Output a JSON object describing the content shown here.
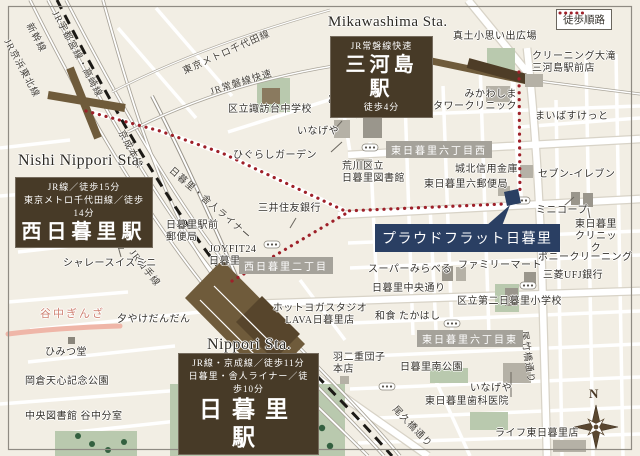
{
  "legend": {
    "label": "徒歩順路"
  },
  "compass": {
    "label": "N"
  },
  "property": {
    "label": "プラウドフラット日暮里"
  },
  "stations": {
    "mikawashima": {
      "en": "Mikawashima Sta.",
      "line1": "JR常磐線快速",
      "name": "三河島駅",
      "walk": "徒歩4分"
    },
    "nishi_nippori": {
      "en": "Nishi Nippori Sta.",
      "line1": "JR線／徒歩15分",
      "line2": "東京メトロ千代田線／徒歩14分",
      "name": "西日暮里駅"
    },
    "nippori": {
      "en": "Nippori Sta.",
      "line1": "JR線・京成線／徒歩11分",
      "line2": "日暮里・舎人ライナー／徒歩10分",
      "name": "日暮里駅"
    }
  },
  "rail_labels": {
    "keihin_tohoku": "JR京浜東北線",
    "shinkansen": "新幹線",
    "utsunomiya_takasaki": "JR宇都宮線・高崎線",
    "chiyoda": "東京メトロ千代田線",
    "joban": "JR常磐線快速",
    "keisei": "京成本線",
    "toneri_liner": "日暮里・舎人ライナー",
    "yamanote": "JR山手線",
    "otakebashi_dori": "尾竹橋通り",
    "ogubashi_dori": "尾久橋通り"
  },
  "districts": {
    "higashi6_west": "東日暮里六丁目西",
    "nishi2": "西日暮里二丁目",
    "higashi6_east": "東日暮里六丁目東"
  },
  "pois": [
    "真土小思い出広場",
    "クリーニング大滝\n三河島駅前店",
    "みかわしま\nタワークリニック",
    "まいばすけっと",
    "どらっぐぱぱす",
    "区立諏訪台中学校",
    "いなげや",
    "ひぐらしガーデン",
    "荒川区立\n日暮里図書館",
    "城北信用金庫",
    "東日暮里六郵便局",
    "セブン-イレブン",
    "ミニコープ",
    "東日暮里\nクリニック",
    "三井住友銀行",
    "日暮里駅前\n郵便局",
    "JOYFIT24\n日暮里",
    "スーパーみらべる",
    "ファミリーマート",
    "ポニークリーニング",
    "三菱UFJ銀行",
    "区立第二日暮里小学校",
    "和食 たかはし",
    "ホットヨガスタジオ\nLAVA日暮里店",
    "シャレースイスミニ",
    "ひみつ堂",
    "岡倉天心記念公園",
    "中央図書館 谷中分室",
    "羽二重団子\n本店",
    "日暮里南公園",
    "いなげや",
    "東日暮里歯科医院",
    "ライフ東日暮里店",
    "夕やけだんだん",
    "日暮里中央通り",
    "谷中ぎんざ"
  ],
  "colors": {
    "route_red": "#9e2029",
    "station_box_brown": "#473a27",
    "property_navy": "#2a3f63",
    "district_gray": "#a5a29a",
    "park_green": "#b9c9ae",
    "rail_brown": "#6f5b3b",
    "yanaka_pink": "#efb6a8"
  }
}
